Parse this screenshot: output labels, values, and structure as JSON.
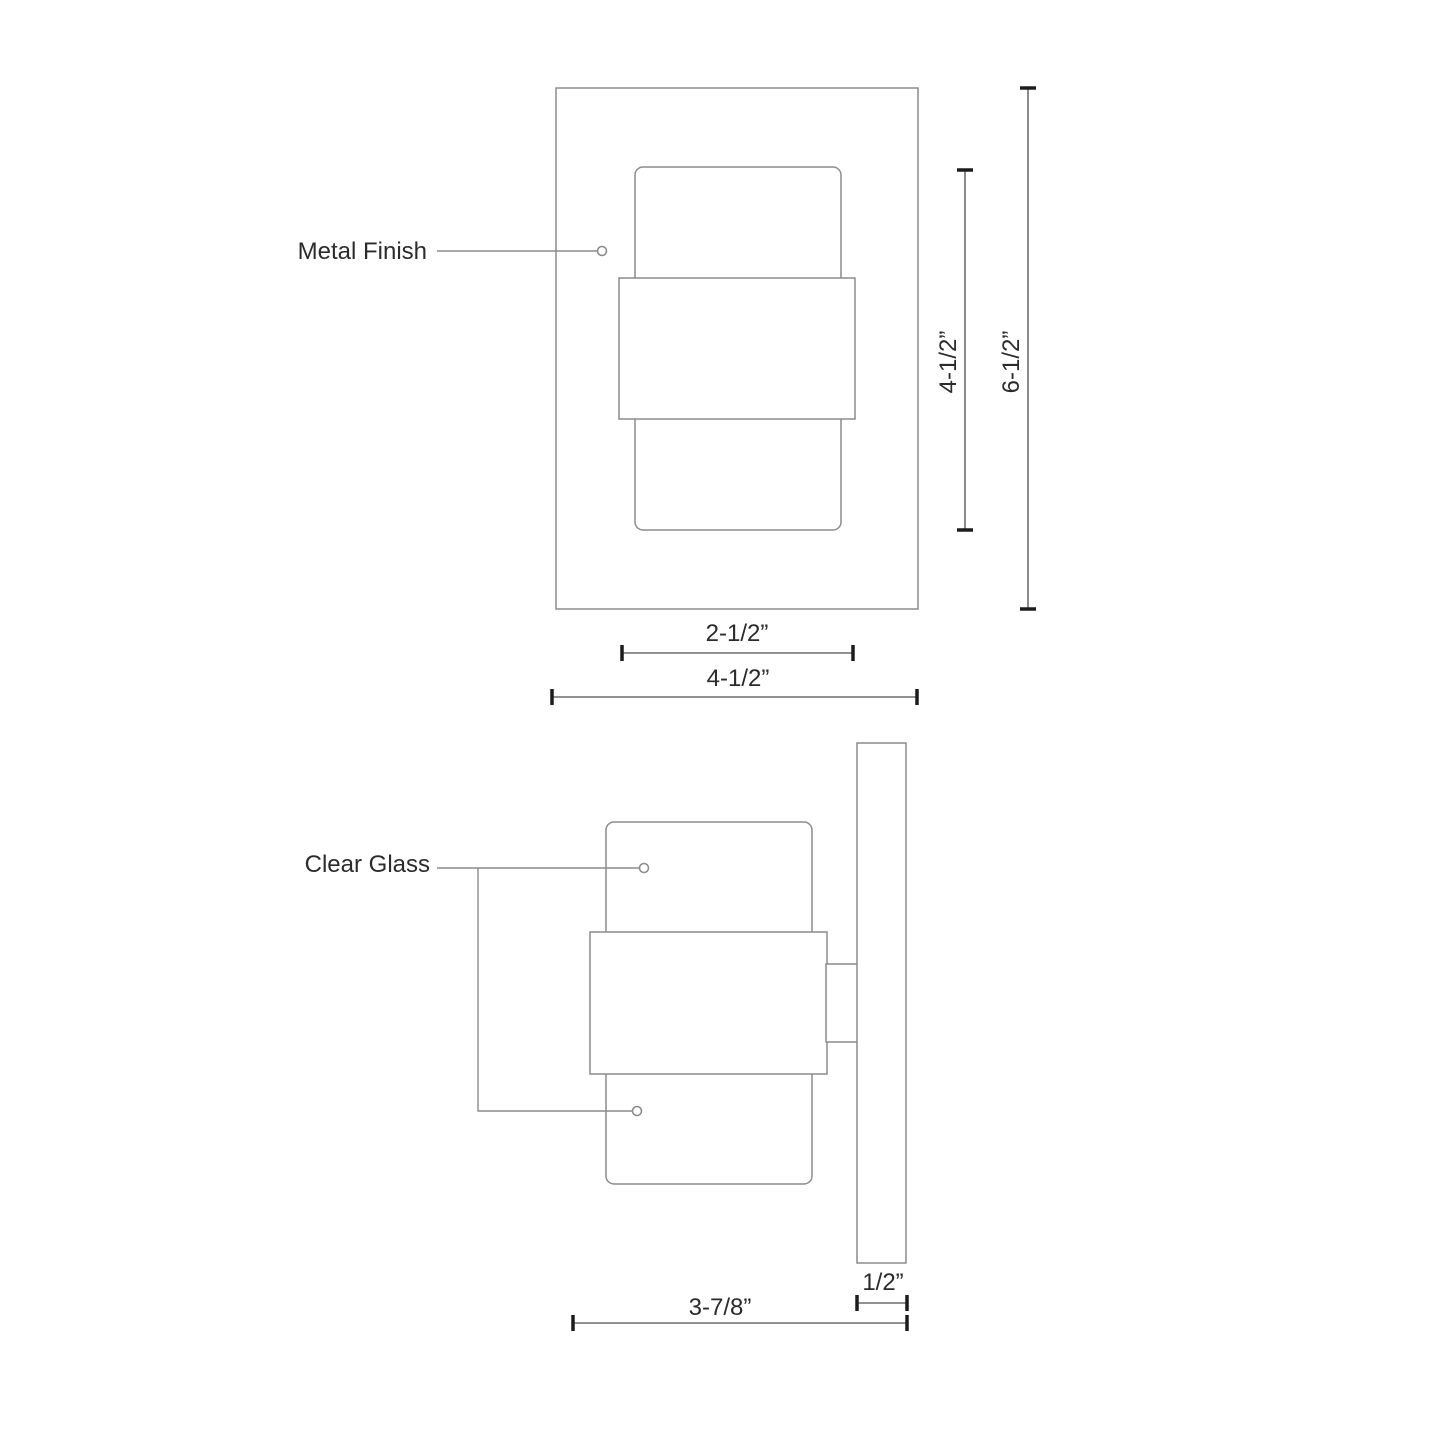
{
  "diagram": {
    "title": "wall-sconce-dimension-drawing",
    "front_view": {
      "label_metal_finish": "Metal Finish",
      "dim_inner_height": "4-1/2”",
      "dim_overall_height": "6-1/2”",
      "dim_inner_width": "2-1/2”",
      "dim_overall_width": "4-1/2”"
    },
    "side_view": {
      "label_clear_glass": "Clear Glass",
      "dim_body_depth": "3-7/8”",
      "dim_plate_depth": "1/2”"
    },
    "colors": {
      "background": "#ffffff",
      "shape_line": "#8c8c8c",
      "dimension_line": "#6e6e6e",
      "tick": "#1c1c1c",
      "text": "#2b2b2b"
    }
  }
}
